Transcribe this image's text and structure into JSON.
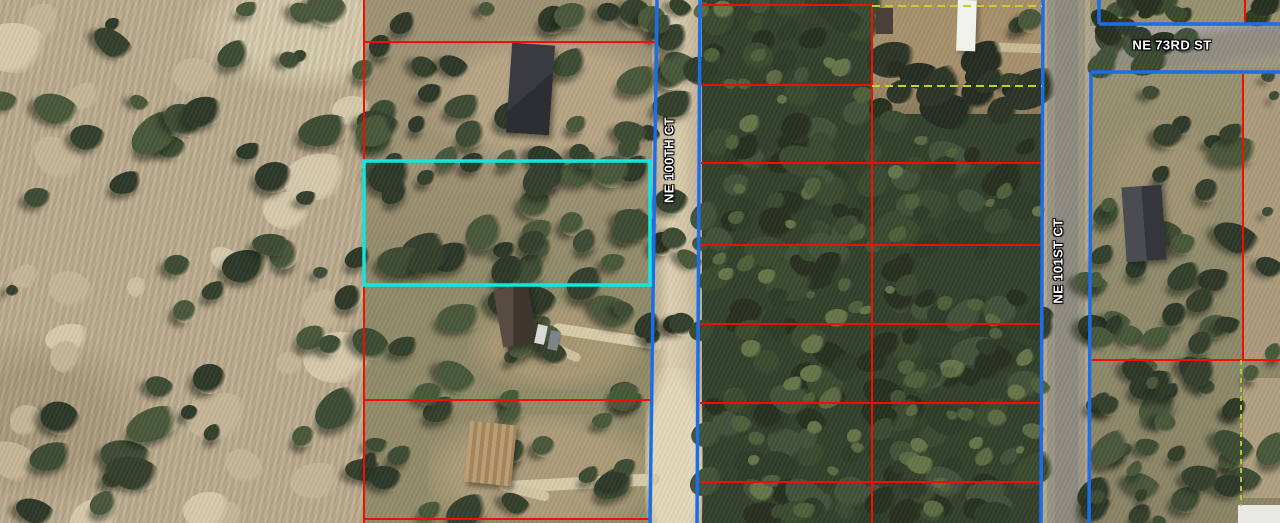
{
  "map": {
    "description": "aerial parcel map with property boundary overlay",
    "labels": [
      {
        "id": "ne-100th-ct",
        "text": "NE 100TH CT",
        "x": 669,
        "y": 160,
        "rotation": -90
      },
      {
        "id": "ne-101st-ct",
        "text": "NE 101ST CT",
        "x": 1058,
        "y": 261,
        "rotation": -90
      },
      {
        "id": "ne-73rd-st",
        "text": "NE 73RD ST",
        "x": 1172,
        "y": 45,
        "rotation": 0
      }
    ],
    "colors": {
      "parcel_boundary": "#f01000",
      "row_boundary": "#1c6ee8",
      "selected_parcel": "#12e6de",
      "survey_dashed": "#c6ce35",
      "easement_dashed": "#aec83a",
      "label_text": "#ffffff",
      "label_outline": "#000000"
    },
    "selected_parcel": {
      "x": 364,
      "y": 161,
      "width": 286,
      "height": 124
    },
    "parcel_lines": {
      "red": [
        [
          364,
          0,
          364,
          523
        ],
        [
          364,
          42,
          655,
          42
        ],
        [
          364,
          400,
          652,
          400
        ],
        [
          364,
          519,
          650,
          519
        ],
        [
          872,
          4,
          872,
          523
        ],
        [
          700,
          5,
          872,
          5
        ],
        [
          700,
          85,
          872,
          85
        ],
        [
          700,
          163,
          1042,
          163
        ],
        [
          700,
          245,
          1042,
          245
        ],
        [
          700,
          324,
          1042,
          324
        ],
        [
          700,
          403,
          1042,
          403
        ],
        [
          700,
          482,
          1042,
          482
        ],
        [
          1245,
          0,
          1245,
          24
        ],
        [
          1243,
          74,
          1243,
          360
        ],
        [
          1092,
          360,
          1280,
          360
        ]
      ],
      "blue": [
        [
          657,
          0,
          650,
          523
        ],
        [
          700,
          0,
          697,
          523
        ],
        [
          1043,
          0,
          1041,
          523
        ],
        [
          1091,
          72,
          1089,
          523
        ],
        [
          1091,
          72,
          1280,
          72
        ],
        [
          1099,
          0,
          1099,
          24
        ],
        [
          1099,
          24,
          1280,
          24
        ]
      ],
      "dashed_yellow": [
        [
          872,
          6,
          1042,
          6
        ],
        [
          872,
          86,
          1042,
          86
        ]
      ],
      "dashed_green": [
        [
          1241,
          360,
          1241,
          506
        ]
      ]
    }
  }
}
